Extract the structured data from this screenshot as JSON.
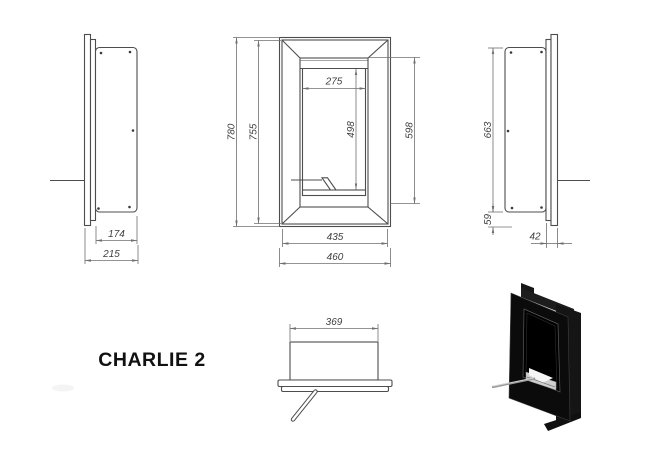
{
  "title": "CHARLIE 2",
  "views": {
    "left_side": {
      "dims": {
        "body_depth": "174",
        "total_depth": "215"
      }
    },
    "front": {
      "dims": {
        "outer_height": "780",
        "plate_height": "755",
        "opening_width": "275",
        "opening_height": "498",
        "inset_height": "598",
        "plate_width": "435",
        "outer_width": "460"
      }
    },
    "right_side": {
      "dims": {
        "body_height": "663",
        "bottom_offset": "59",
        "frame_depth": "42"
      }
    },
    "top": {
      "dims": {
        "body_width": "369"
      }
    }
  },
  "colors": {
    "background": "#ffffff",
    "drawing_line": "#4d4d4d",
    "dimension_line": "#6f6f6f",
    "dimension_text": "#3f3f3f",
    "title_text": "#111111",
    "render_body": "#0b0b0b",
    "casing_dark": "#181818",
    "burner_silver": "#d9d9d9",
    "lever_gray": "#999999"
  }
}
